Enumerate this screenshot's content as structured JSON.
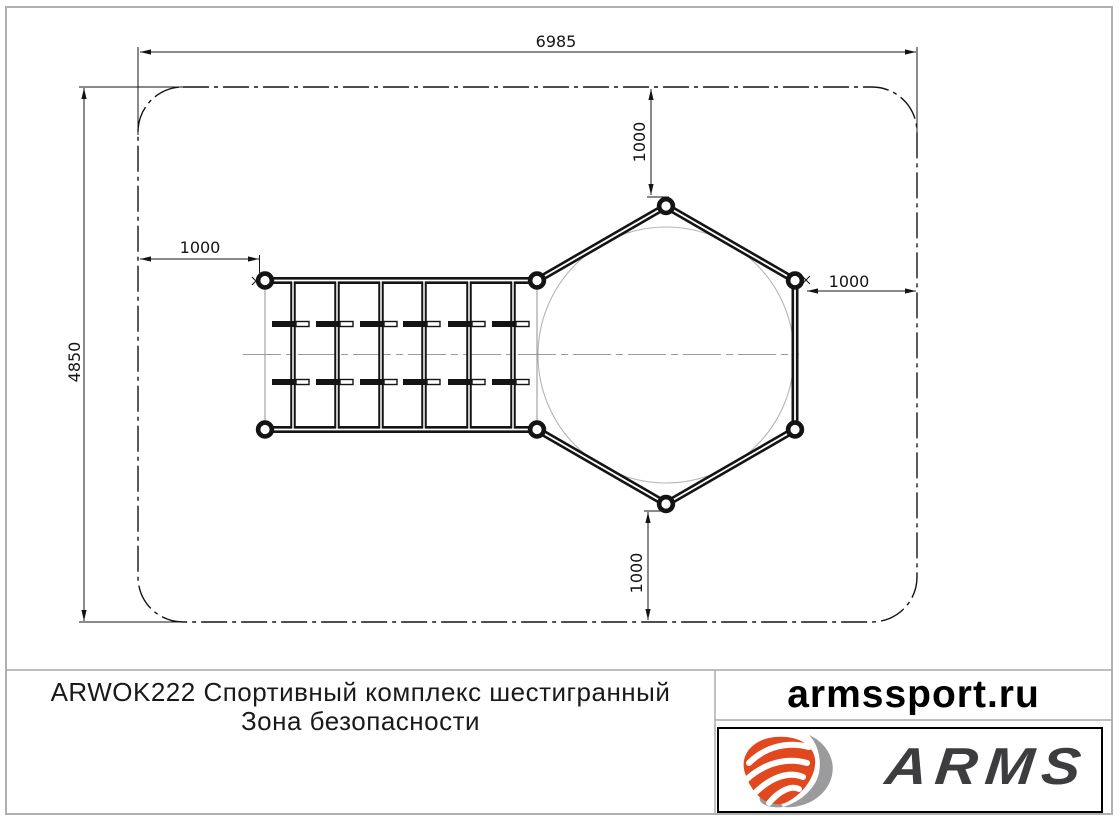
{
  "drawing": {
    "dim_width": "6985",
    "dim_height": "4850",
    "dim_offset_left": "1000",
    "dim_offset_top": "1000",
    "dim_offset_right": "1000",
    "dim_offset_bottom": "1000"
  },
  "title_block": {
    "product_line": "ARWOK222 Спортивный комплекс шестигранный",
    "zone_line": "Зона безопасности",
    "website": "armssport.ru",
    "brand": "ARMS"
  },
  "colors": {
    "drawing_line": "#141414",
    "construction_gray": "#9a9a9a",
    "page_border": "#b0b0b0",
    "logo_orange": "#e2481d",
    "logo_gray": "#9b9b9d",
    "logo_text": "#3d3d3f"
  },
  "icons": {
    "brand_mark": "arms-shield-swoosh-icon"
  }
}
